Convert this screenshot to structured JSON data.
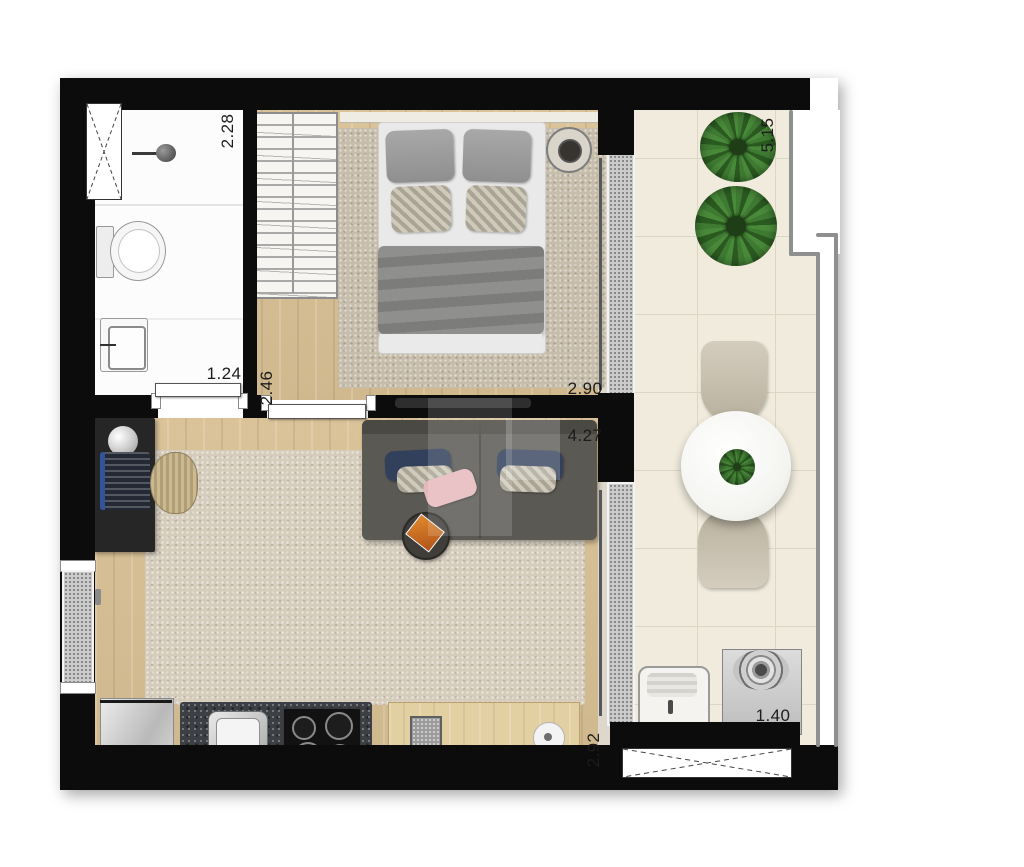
{
  "plan": {
    "type": "floor-plan",
    "description": "studio apartment top-view floor plan with balcony",
    "labels": {
      "bathroom_depth": {
        "text": "2.28",
        "orientation": "vertical"
      },
      "balcony_length": {
        "text": "5.15",
        "orientation": "vertical"
      },
      "bathroom_door": {
        "text": "1.24",
        "orientation": "horizontal"
      },
      "hall_width": {
        "text": "2.46",
        "orientation": "vertical"
      },
      "bedroom_width": {
        "text": "2.90",
        "orientation": "horizontal"
      },
      "living_width": {
        "text": "4.27",
        "orientation": "horizontal"
      },
      "kitchen_depth": {
        "text": "2.92",
        "orientation": "vertical"
      },
      "service_width": {
        "text": "1.40",
        "orientation": "horizontal"
      }
    },
    "colors": {
      "wall": "#0c0c0c",
      "wood_floor": "#d9c094",
      "balcony_tile": "#f0ebdd",
      "rug": "#c7bdab",
      "granite_counter": "#3c3f43",
      "sofa": "#5b5954",
      "navy_pillow": "#32405c",
      "pink_pillow": "#e5b9bc",
      "plant_green": "#3f7a33"
    },
    "rooms": {
      "bathroom": {
        "fixtures": [
          "x-window",
          "shower",
          "toilet",
          "washbasin"
        ]
      },
      "bedroom": {
        "fixtures": [
          "wardrobe",
          "double-bed",
          "bedside-table",
          "rug",
          "tv-panel",
          "sliding-door"
        ]
      },
      "living": {
        "fixtures": [
          "desk",
          "lamp",
          "laptop",
          "chair",
          "sofa",
          "side-table",
          "rug",
          "entry-glass"
        ]
      },
      "kitchen": {
        "fixtures": [
          "fridge",
          "sink",
          "cooktop",
          "wood-counter"
        ]
      },
      "balcony": {
        "fixtures": [
          "plant",
          "plant",
          "dining-table",
          "chair",
          "chair",
          "centerpiece-plant",
          "glass-railing"
        ]
      },
      "service": {
        "fixtures": [
          "laundry-tank",
          "washing-machine",
          "x-vent-window"
        ]
      }
    }
  }
}
